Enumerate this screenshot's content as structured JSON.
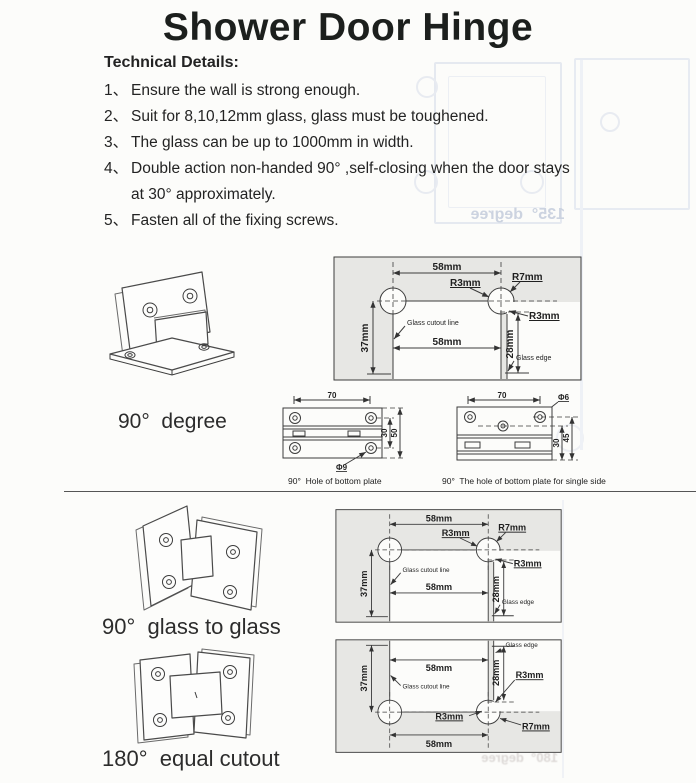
{
  "title": "Shower Door Hinge",
  "tech": {
    "heading": "Technical Details:",
    "items": [
      {
        "num": "1、",
        "lines": [
          "Ensure the wall is strong enough."
        ]
      },
      {
        "num": "2、",
        "lines": [
          "Suit for 8,10,12mm glass, glass must be toughened."
        ]
      },
      {
        "num": "3、",
        "lines": [
          "The glass can be up to 1000mm in width."
        ]
      },
      {
        "num": "4、",
        "lines": [
          "Double action non-handed 90° ,self-closing when the door stays",
          "at 30°  approximately."
        ]
      },
      {
        "num": "5、",
        "lines": [
          "Fasten all of the fixing screws."
        ]
      }
    ]
  },
  "variants": {
    "deg90": "90°  degree",
    "glass90": "90°  glass to glass",
    "equal180": "180°  equal cutout"
  },
  "cutout": {
    "w58": "58mm",
    "r3": "R3mm",
    "r7": "R7mm",
    "h37": "37mm",
    "h28": "28mm",
    "cut_line": "Glass cutout line",
    "edge": "Glass edge"
  },
  "plates": {
    "w70": "70",
    "dia9": "Φ9",
    "dia6": "Φ6",
    "h30": "30",
    "h50": "50",
    "h45": "45",
    "caption_a": "90°  Hole of bottom plate",
    "caption_b": "90°  The hole of bottom plate for single side"
  },
  "ghost": {
    "text135": "135°  degree",
    "text180": "180°  degree"
  }
}
